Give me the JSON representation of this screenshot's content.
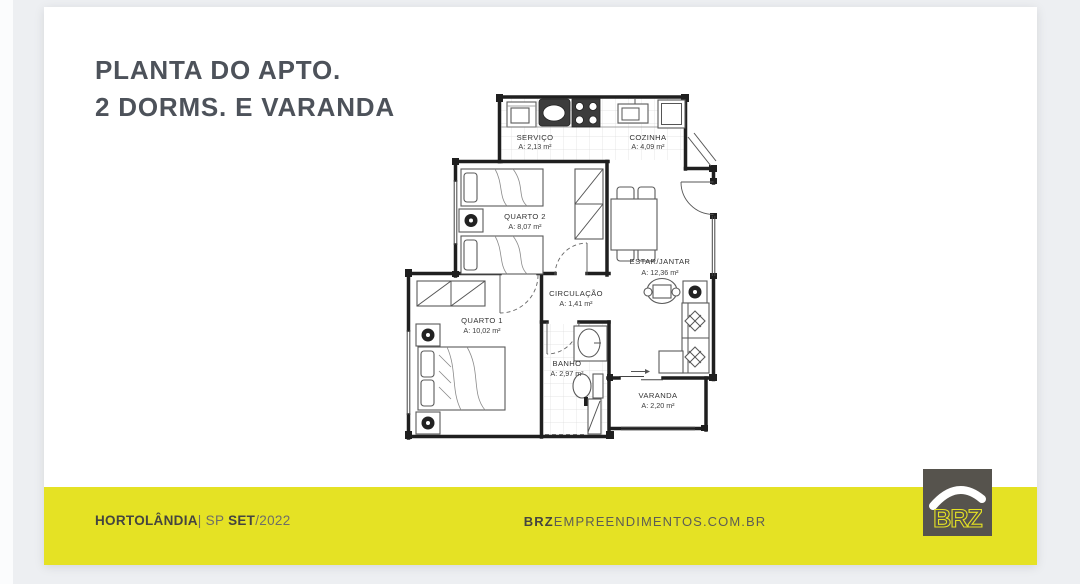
{
  "title": {
    "line1": "PLANTA DO APTO.",
    "line2": "2 DORMS. E VARANDA"
  },
  "plan": {
    "rooms": {
      "servico": {
        "name": "SERVIÇO",
        "area": "A: 2,13 m²"
      },
      "cozinha": {
        "name": "COZINHA",
        "area": "A: 4,09 m²"
      },
      "quarto2": {
        "name": "QUARTO 2",
        "area": "A: 8,07 m²"
      },
      "estar": {
        "name": "ESTAR/JANTAR",
        "area": "A: 12,36 m²"
      },
      "circulacao": {
        "name": "CIRCULAÇÃO",
        "area": "A: 1,41 m²"
      },
      "quarto1": {
        "name": "QUARTO 1",
        "area": "A: 10,02 m²"
      },
      "banho": {
        "name": "BANHO",
        "area": "A: 2,97 m²"
      },
      "varanda": {
        "name": "VARANDA",
        "area": "A: 2,20 m²"
      }
    }
  },
  "footer": {
    "city": "HORTOLÂNDIA",
    "separator": "| SP ",
    "month": "SET",
    "year": "/2022",
    "website_prefix": "BRZ",
    "website_rest": "EMPREENDIMENTOS.COM.BR"
  },
  "logo": {
    "text": "BRZ"
  },
  "colors": {
    "accent_yellow": "#e5e224",
    "logo_gray": "#56534d",
    "title_gray": "#4d525a"
  }
}
